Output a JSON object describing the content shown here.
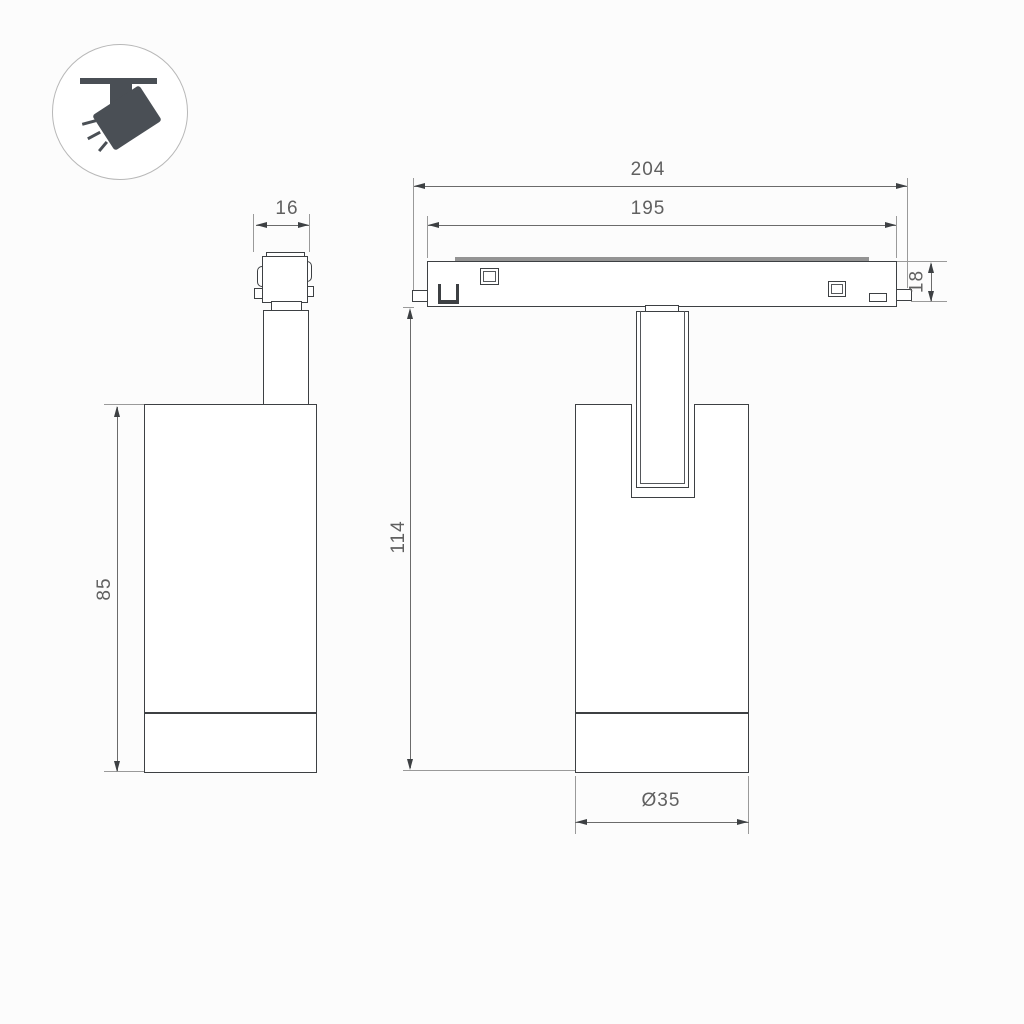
{
  "title": "Track spotlight dimension drawing",
  "background": "#fcfcfc",
  "colors": {
    "line": "#3d4043",
    "dimension_line": "#6b6b6b",
    "extension_line": "#9a9a9a",
    "label_text": "#606060",
    "icon_glyph": "#4a4f55",
    "icon_circle_stroke": "#b8b8b8",
    "magnet_strip": "#949494"
  },
  "icon": {
    "name": "track-spotlight"
  },
  "labels": {
    "connector_width": "16",
    "body_height": "85",
    "track_length_outer": "204",
    "track_length_inner": "195",
    "track_height": "18",
    "total_height": "114",
    "body_diameter": "Ø35"
  }
}
